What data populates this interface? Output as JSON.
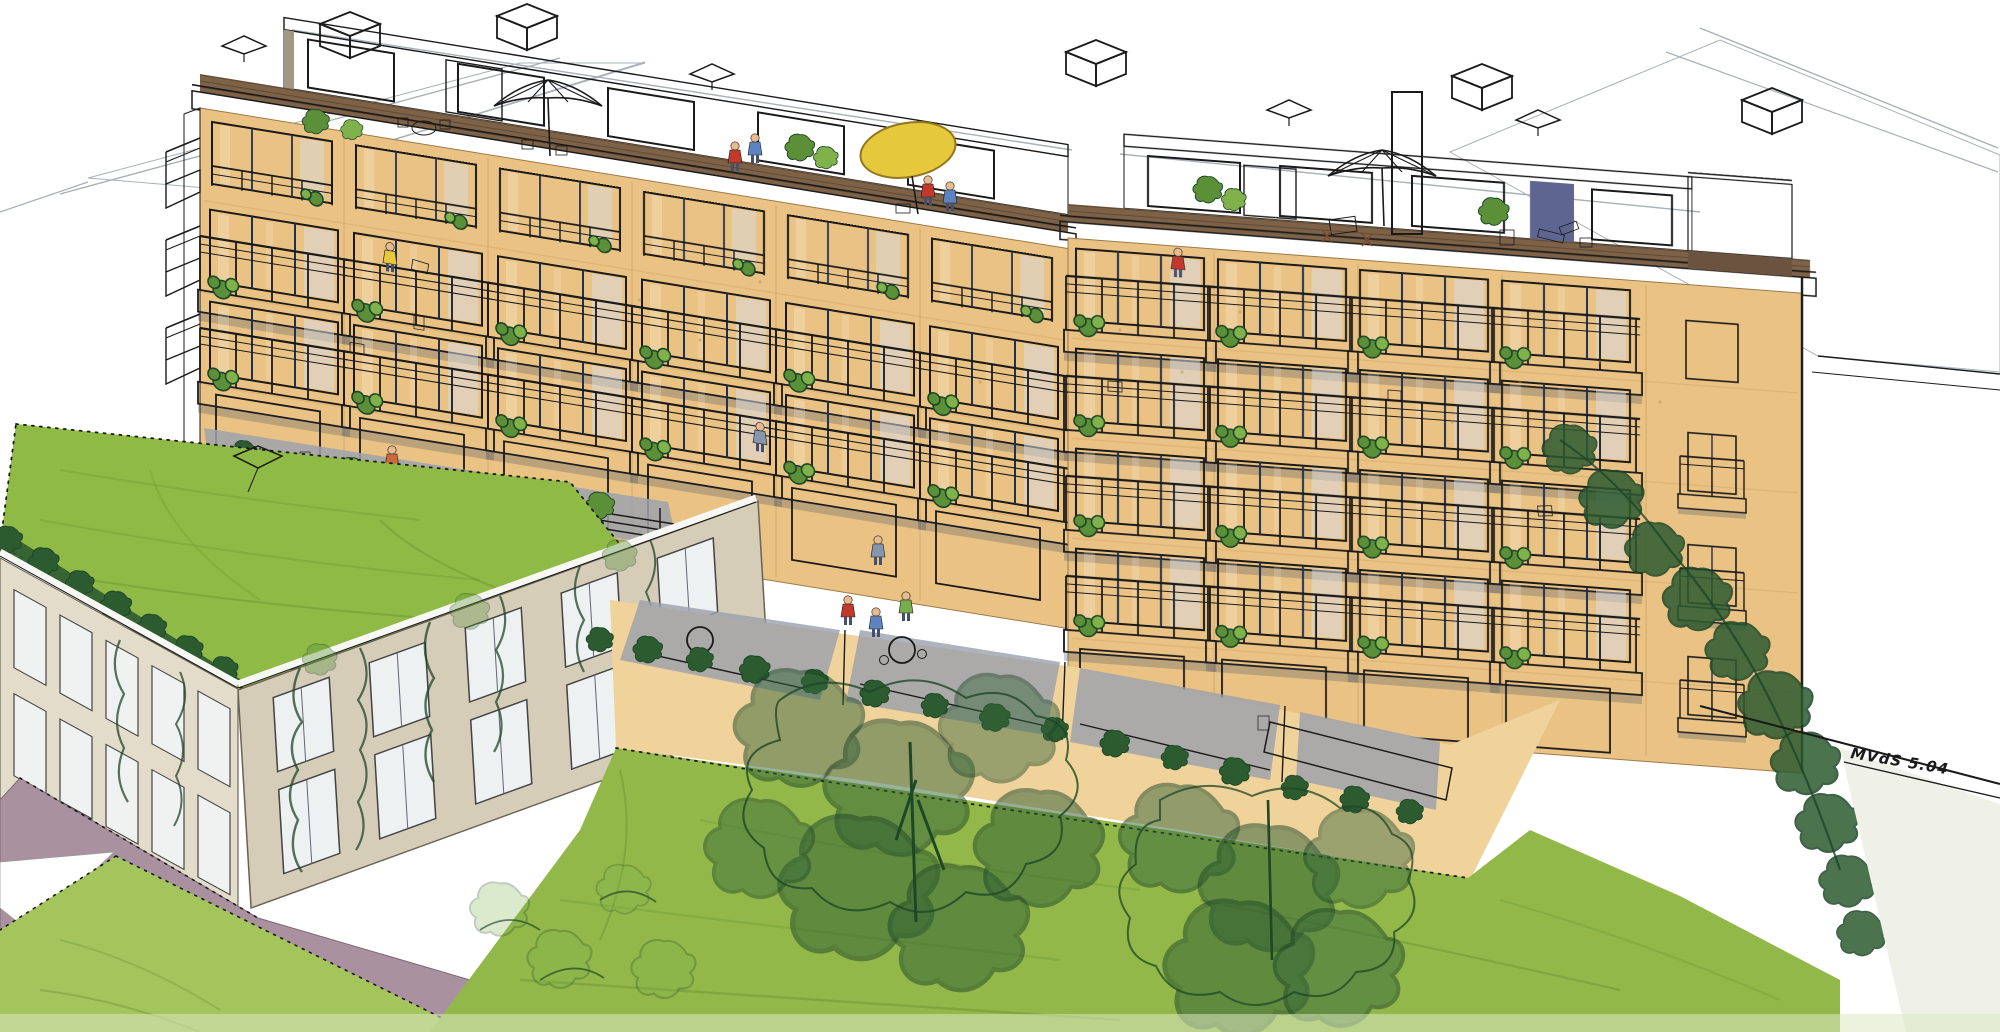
{
  "artwork": {
    "kind": "Architectural concept rendering",
    "medium": "Ink and marker perspective sketch",
    "description": "Aerial perspective sketch of a five-storey apartment building with set-back penthouse roof terraces, stacked balconies with plants and figures, a green-roof podium lawn, an ivy-covered annex wing and a sloping communal garden with mature trees",
    "signature": {
      "text": "MVdS 5.04"
    }
  },
  "palette": {
    "paper": "#FFFFFF",
    "ink": "#1A1A1A",
    "pencil": "#A9B0B6",
    "facade": "#EAC384",
    "facade_shadow": "#D8AB66",
    "penthouse": "#B5AB97",
    "penthouse_shadow": "#A39885",
    "roof_white": "#FDFDFB",
    "glass_dark": "#46597F",
    "glass_mid": "#5E74A0",
    "glass_light": "#8FA3C4",
    "balcony_white": "#F6F6F1",
    "mesh_line": "#C6C6BE",
    "deck_brown": "#7D6248",
    "parapet": "#F7F7F3",
    "lawn": "#8FBA45",
    "lawn_light": "#A4C45C",
    "garden": "#92B84A",
    "hedge": "#2C5B30",
    "tree_line": "#1E4627",
    "plant": "#5B9038",
    "plant_light": "#7FB24A",
    "annex_front": "#D6CDB9",
    "annex_side": "#E3DCCB",
    "paving_mauve": "#A9919F",
    "terrace_gray": "#9AA0AC",
    "umbrella_white": "#F4F3EC",
    "umbrella_yellow": "#E5C83C",
    "accent_red": "#C0392B",
    "accent_terracotta": "#B16B4C",
    "figure_blue": "#5D84C0",
    "figure_green": "#77AD4A",
    "figure_orange": "#C96A3A",
    "pot_red": "#C14B34"
  },
  "scene": {
    "labels": {
      "main_building": "Apartment block with balconies",
      "penthouse_terraces": "Set-back penthouse level with planted roof terraces and parasols",
      "roof_fixtures": "Rooftop chimney boxes and skylights",
      "podium_lawn": "Green roof podium lawn with skylight",
      "annex": "Lower annex wing with roof hedge and climbing plants",
      "garden": "Sloping communal lawn with mature trees",
      "neighbor_roof_left": "Adjacent roof sketched in pencil",
      "neighbor_roof_right": "Adjacent standing-seam roof",
      "signature": "Artist signature and date"
    }
  }
}
